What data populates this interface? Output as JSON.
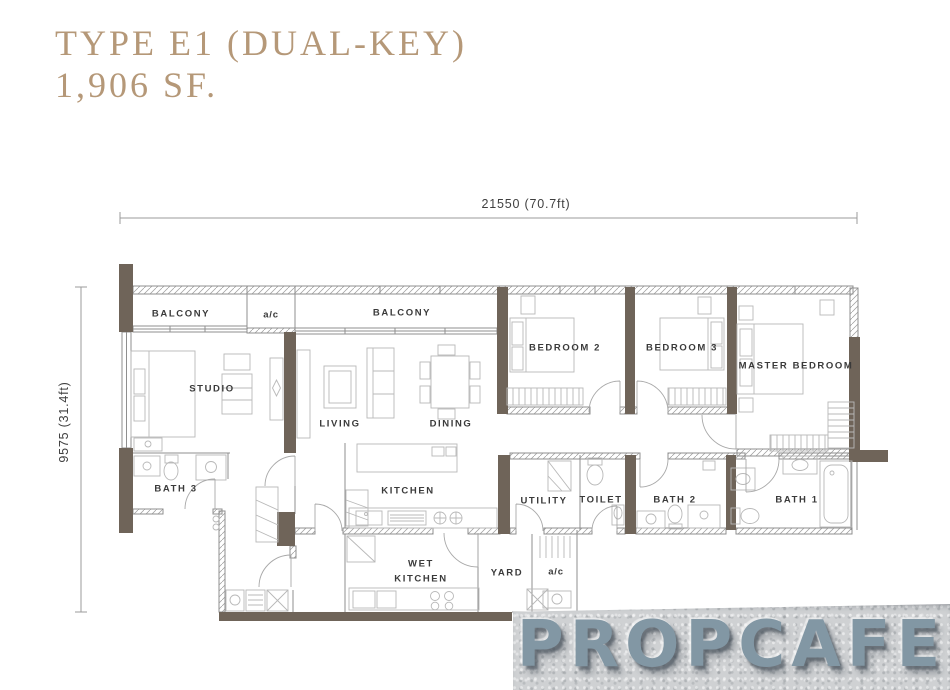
{
  "title": {
    "line1": "TYPE E1 (DUAL-KEY)",
    "line2": "1,906 SF."
  },
  "dimensions": {
    "horizontal": "21550 (70.7ft)",
    "vertical": "9575 (31.4ft)"
  },
  "rooms": {
    "balcony_left": "BALCONY",
    "ac_top": "a/c",
    "balcony_mid": "BALCONY",
    "studio": "STUDIO",
    "living": "LIVING",
    "dining": "DINING",
    "bedroom2": "BEDROOM 2",
    "bedroom3": "BEDROOM 3",
    "master": "MASTER BEDROOM",
    "bath3": "BATH 3",
    "kitchen": "KITCHEN",
    "utility": "UTILITY",
    "toilet": "TOILET",
    "bath2": "BATH 2",
    "bath1": "BATH 1",
    "wet_kitchen": "WET KITCHEN",
    "yard": "YARD",
    "ac_bottom": "a/c"
  },
  "watermark": {
    "text": "PROPCAFE"
  },
  "colors": {
    "title": "#b59878",
    "wall_accent": "#6f6459",
    "label": "#3a3a3a",
    "dim": "#3f3f3f",
    "watermark_text": "#8297a4"
  }
}
